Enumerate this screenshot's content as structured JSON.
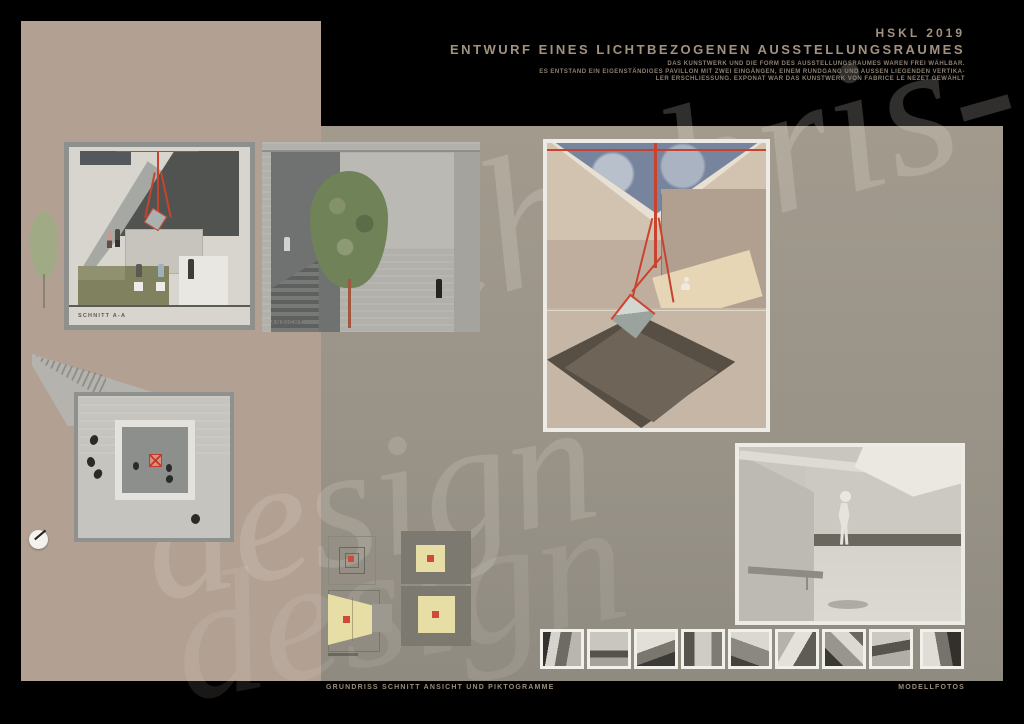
{
  "colors": {
    "background": "#000000",
    "panel_brown": "#b2a193",
    "panel_gray": "#9c968b",
    "accent_red": "#cf4a38",
    "pictogram_yellow": "#e7dea6",
    "header_text": "#a29280"
  },
  "header": {
    "program": "HSKL 2019",
    "title": "ENTWURF EINES LICHTBEZOGENEN AUSSTELLUNGSRAUMES",
    "description_lines": [
      "DAS KUNSTWERK UND DIE FORM DES AUSSTELLUNGSRAUMES WAREN FREI WÄHLBAR.",
      "ES ENTSTAND EIN EIGENSTÄNDIGES PAVILLON MIT ZWEI EINGÄNGEN, EINEM RUNDGANG UND AUSSEN LIEGENDEN VERTIKA-",
      "LER ERSCHLIESSUNG. EXPONAT WAR DAS KUNSTWERK VON FABRICE LE NEZET GEWÄHLT"
    ]
  },
  "drawings": {
    "section_label": "SCHNITT A-A",
    "elevation_label": "ANSICHT"
  },
  "footer": {
    "left_caption": "GRUNDRISS SCHNITT ANSICHT UND PIKTOGRAMME",
    "right_caption": "MODELLFOTOS"
  },
  "watermark": {
    "fragments": [
      "chubris-",
      "design",
      "design"
    ]
  },
  "filmstrip": {
    "count": 9
  }
}
